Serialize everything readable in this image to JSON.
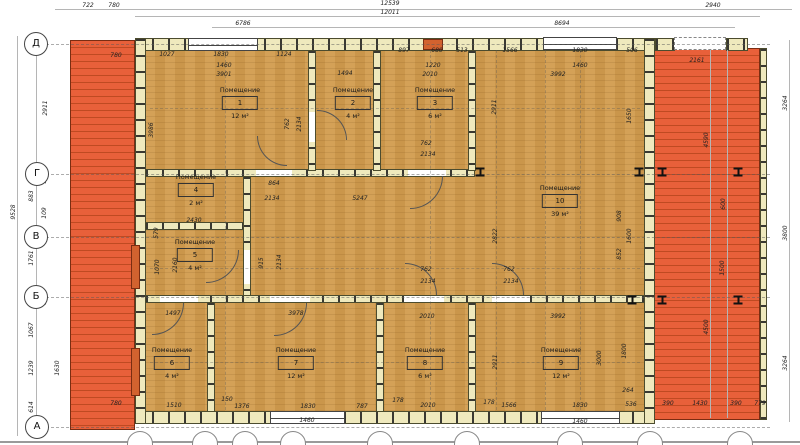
{
  "drawing": {
    "room_label_word": "Помещение",
    "rooms": [
      {
        "num": "1",
        "area": "12 м²",
        "cx": 240,
        "cy": 86
      },
      {
        "num": "2",
        "area": "4 м²",
        "cx": 353,
        "cy": 86
      },
      {
        "num": "3",
        "area": "6 м²",
        "cx": 435,
        "cy": 86
      },
      {
        "num": "4",
        "area": "2 м²",
        "cx": 196,
        "cy": 173
      },
      {
        "num": "5",
        "area": "4 м²",
        "cx": 195,
        "cy": 238
      },
      {
        "num": "6",
        "area": "4 м²",
        "cx": 172,
        "cy": 346
      },
      {
        "num": "7",
        "area": "12 м²",
        "cx": 296,
        "cy": 346
      },
      {
        "num": "8",
        "area": "6 м²",
        "cx": 425,
        "cy": 346
      },
      {
        "num": "9",
        "area": "12 м²",
        "cx": 561,
        "cy": 346
      },
      {
        "num": "10",
        "area": "39 м²",
        "cx": 560,
        "cy": 184
      }
    ],
    "axis_bubbles": [
      {
        "label": "Д",
        "x": 36,
        "y": 44
      },
      {
        "label": "Г",
        "x": 37,
        "y": 174
      },
      {
        "label": "В",
        "x": 36,
        "y": 237
      },
      {
        "label": "Б",
        "x": 36,
        "y": 297
      },
      {
        "label": "А",
        "x": 37,
        "y": 427
      }
    ],
    "bottom_bubbles_x": [
      140,
      205,
      245,
      293,
      380,
      467,
      570,
      650,
      740
    ],
    "beams": [
      [
        480,
        172
      ],
      [
        639,
        172
      ],
      [
        662,
        172
      ],
      [
        738,
        172
      ],
      [
        632,
        300
      ],
      [
        662,
        300
      ],
      [
        738,
        300
      ]
    ],
    "dims": [
      [
        "722",
        88,
        6,
        0
      ],
      [
        "780",
        114,
        6,
        0
      ],
      [
        "12539",
        390,
        4,
        0
      ],
      [
        "12011",
        390,
        13,
        0
      ],
      [
        "2940",
        713,
        6,
        0
      ],
      [
        "6786",
        243,
        24,
        0
      ],
      [
        "8694",
        562,
        24,
        0
      ],
      [
        "780",
        116,
        56,
        0
      ],
      [
        "1027",
        167,
        55,
        0
      ],
      [
        "1830",
        221,
        55,
        0
      ],
      [
        "1124",
        284,
        55,
        0
      ],
      [
        "897",
        404,
        51,
        0
      ],
      [
        "680",
        437,
        51,
        0
      ],
      [
        "513",
        462,
        51,
        0
      ],
      [
        "1566",
        510,
        51,
        0
      ],
      [
        "1830",
        580,
        51,
        0
      ],
      [
        "506",
        632,
        51,
        0
      ],
      [
        "2161",
        697,
        61,
        0
      ],
      [
        "1460",
        224,
        66,
        0
      ],
      [
        "3901",
        224,
        75,
        0
      ],
      [
        "1494",
        345,
        74,
        0
      ],
      [
        "1220",
        433,
        66,
        0
      ],
      [
        "2010",
        430,
        75,
        0
      ],
      [
        "1460",
        580,
        66,
        0
      ],
      [
        "3992",
        558,
        75,
        0
      ],
      [
        "2911",
        46,
        108,
        1
      ],
      [
        "9528",
        14,
        212,
        1
      ],
      [
        "883",
        32,
        196,
        1
      ],
      [
        "108",
        45,
        178,
        1
      ],
      [
        "109",
        45,
        213,
        1
      ],
      [
        "1761",
        32,
        258,
        1
      ],
      [
        "178",
        45,
        299,
        1
      ],
      [
        "1067",
        32,
        330,
        1
      ],
      [
        "1239",
        32,
        368,
        1
      ],
      [
        "1630",
        58,
        368,
        1
      ],
      [
        "614",
        32,
        407,
        1
      ],
      [
        "3986",
        152,
        130,
        1
      ],
      [
        "762",
        288,
        124,
        1
      ],
      [
        "2134",
        300,
        124,
        1
      ],
      [
        "2911",
        495,
        107,
        1
      ],
      [
        "1650",
        630,
        116,
        1
      ],
      [
        "864",
        274,
        184,
        0
      ],
      [
        "2134",
        272,
        199,
        0
      ],
      [
        "5247",
        360,
        199,
        0
      ],
      [
        "2430",
        194,
        221,
        0
      ],
      [
        "762",
        426,
        144,
        0
      ],
      [
        "2134",
        428,
        155,
        0
      ],
      [
        "579",
        157,
        233,
        1
      ],
      [
        "1070",
        158,
        267,
        1
      ],
      [
        "2160",
        176,
        265,
        1
      ],
      [
        "915",
        262,
        263,
        1
      ],
      [
        "2134",
        280,
        262,
        1
      ],
      [
        "2822",
        496,
        236,
        1
      ],
      [
        "908",
        620,
        216,
        1
      ],
      [
        "1600",
        630,
        236,
        1
      ],
      [
        "852",
        620,
        254,
        1
      ],
      [
        "762",
        426,
        270,
        0
      ],
      [
        "2134",
        428,
        282,
        0
      ],
      [
        "762",
        509,
        270,
        0
      ],
      [
        "2134",
        511,
        282,
        0
      ],
      [
        "1497",
        173,
        314,
        0
      ],
      [
        "3978",
        296,
        314,
        0
      ],
      [
        "2010",
        427,
        317,
        0
      ],
      [
        "3992",
        558,
        317,
        0
      ],
      [
        "2911",
        496,
        362,
        1
      ],
      [
        "3000",
        600,
        358,
        1
      ],
      [
        "1800",
        625,
        351,
        1
      ],
      [
        "264",
        628,
        391,
        0
      ],
      [
        "536",
        631,
        405,
        0
      ],
      [
        "780",
        116,
        404,
        0
      ],
      [
        "1510",
        174,
        406,
        0
      ],
      [
        "150",
        227,
        400,
        0
      ],
      [
        "1376",
        242,
        407,
        0
      ],
      [
        "1830",
        308,
        407,
        0
      ],
      [
        "787",
        362,
        407,
        0
      ],
      [
        "178",
        398,
        401,
        0
      ],
      [
        "2010",
        428,
        406,
        0
      ],
      [
        "1460",
        307,
        421,
        0
      ],
      [
        "178",
        489,
        403,
        0
      ],
      [
        "1566",
        509,
        406,
        0
      ],
      [
        "1830",
        580,
        406,
        0
      ],
      [
        "1460",
        580,
        422,
        0
      ],
      [
        "3264",
        786,
        103,
        1
      ],
      [
        "4590",
        707,
        140,
        1
      ],
      [
        "600",
        724,
        204,
        1
      ],
      [
        "1500",
        723,
        268,
        1
      ],
      [
        "4500",
        707,
        327,
        1
      ],
      [
        "3800",
        786,
        233,
        1
      ],
      [
        "3264",
        786,
        363,
        1
      ],
      [
        "390",
        668,
        404,
        0
      ],
      [
        "1430",
        700,
        404,
        0
      ],
      [
        "390",
        736,
        404,
        0
      ],
      [
        "779",
        760,
        404,
        0
      ]
    ]
  }
}
